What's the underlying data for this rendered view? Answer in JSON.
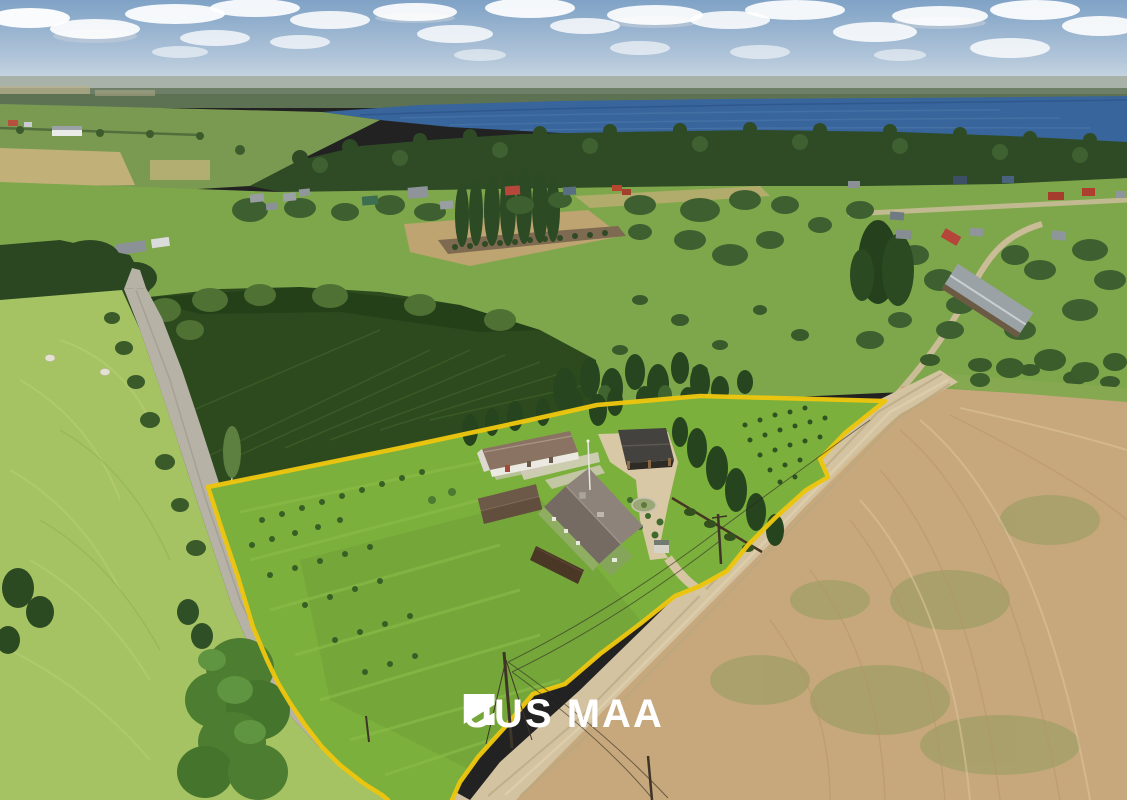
{
  "logo": {
    "text": "UUS MAA",
    "icon": "uusmaa-flag-icon",
    "color": "#ffffff"
  },
  "colors": {
    "boundary_yellow": "#ecc50e",
    "lake_blue": "#38659c",
    "lawn_green": "#7cb03c",
    "wheat_tan": "#c7a87c",
    "road_gray": "#b7b2a6",
    "gravel_tan": "#d3c3a1",
    "forest_dark": "#2c4a1e",
    "sky_top": "#7fa2c6"
  },
  "scene": {
    "type": "aerial-drone-photo",
    "features": [
      "sky-clouds",
      "lake",
      "distant-forest",
      "village-houses",
      "country-road",
      "forest-plantation",
      "property-lawn",
      "yellow-property-boundary",
      "farmhouse",
      "barn",
      "carport",
      "garden-shed",
      "gravel-road",
      "wheat-stubble-field",
      "power-lines",
      "meadow",
      "hay-bales"
    ]
  }
}
